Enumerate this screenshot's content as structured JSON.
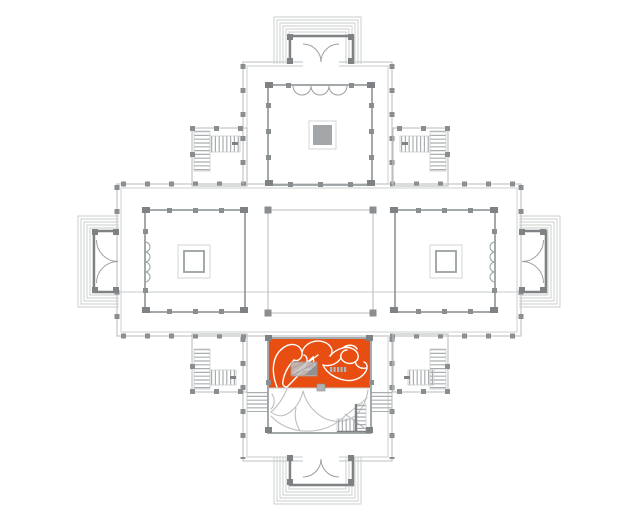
{
  "plan": {
    "type": "symmetric-cross-villa-floor-plan",
    "highlighted_room": {
      "id": "south-room",
      "selected": true
    }
  },
  "colors": {
    "background": "#ffffff",
    "step-line": "#c9cccd",
    "wall-light": "#bcbfc1",
    "wall-medium": "#9aa0a2",
    "wall-dark": "#7e8284",
    "pier": "#8a8e90",
    "fill-gray": "#a2a6a8",
    "highlight": "#e84e12",
    "figure-white": "#ffffff",
    "figure-gray": "#bcbfc1",
    "stair-line": "#a9adaf",
    "detail-gray": "#b0b3b5"
  }
}
